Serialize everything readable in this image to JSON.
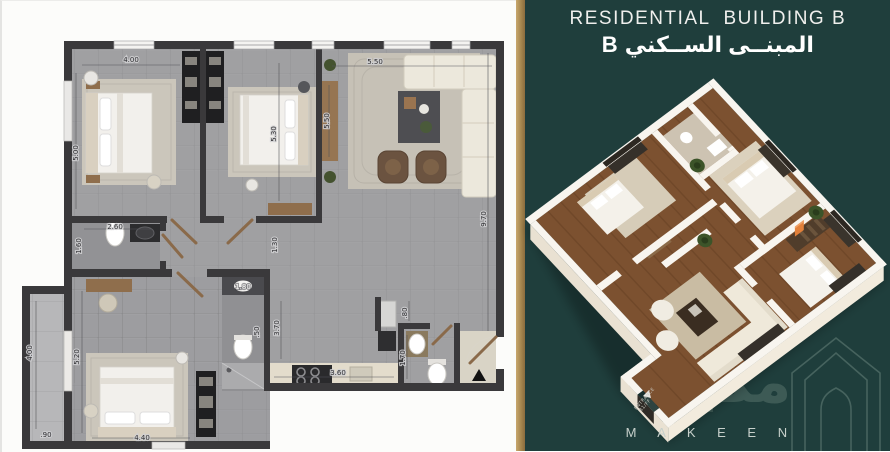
{
  "right_panel": {
    "title_en": "RESIDENTIAL  BUILDING B",
    "title_ar": "المبنــى الســكني B",
    "brand": {
      "name_en": "M A K E E N",
      "name_ar": "مكين"
    },
    "entrance_tag": {
      "line1": "ENTRANCE",
      "line2": "B1/FF"
    },
    "colors": {
      "background": "#1f3e3c",
      "gold_strip": "#a5874f",
      "watermark": "#3d5a55",
      "wood_floor": "#7c5130",
      "wall_white": "#f8f5ef",
      "accent_tag_orange": "#e2803a"
    }
  },
  "floor_plan": {
    "colors": {
      "wall": "#3a393b",
      "floor_gray": "#a0a0a2",
      "balcony_gray": "#b7b7b9",
      "rug": "#cbc6bb",
      "wood": "#8f6e4c",
      "fixture_white": "#f4f3f1"
    },
    "rooms": [
      {
        "id": "bedroom-1",
        "dims": [
          "4.00",
          "5.00"
        ]
      },
      {
        "id": "bedroom-2",
        "dims": [
          "5.30",
          "5.50"
        ]
      },
      {
        "id": "living-room",
        "dims": [
          "5.50",
          "9.70"
        ]
      },
      {
        "id": "bathroom",
        "dims": [
          "2.60",
          "1.60"
        ]
      },
      {
        "id": "corridor",
        "dims": [
          "1.30"
        ]
      },
      {
        "id": "ensuite-bathroom",
        "dims": [
          "1.80",
          ".50"
        ]
      },
      {
        "id": "master-bedroom",
        "dims": [
          "5.20",
          "4.40"
        ]
      },
      {
        "id": "balcony",
        "dims": [
          "4.00",
          ".90"
        ]
      },
      {
        "id": "kitchen",
        "dims": [
          "3.60",
          "3.70"
        ]
      },
      {
        "id": "wc",
        "dims": [
          "1.70",
          ".80"
        ]
      }
    ],
    "dimensions": [
      {
        "v": "4.00",
        "x": 129,
        "y": 61,
        "r": 0
      },
      {
        "v": "5.00",
        "x": 76,
        "y": 152,
        "r": -90
      },
      {
        "v": "5.30",
        "x": 274,
        "y": 133,
        "r": -90
      },
      {
        "v": "5.50",
        "x": 327,
        "y": 120,
        "r": -90
      },
      {
        "v": "5.50",
        "x": 373,
        "y": 63,
        "r": 0
      },
      {
        "v": "9.70",
        "x": 484,
        "y": 218,
        "r": -90
      },
      {
        "v": "2.60",
        "x": 113,
        "y": 228,
        "r": 0
      },
      {
        "v": "1.60",
        "x": 79,
        "y": 245,
        "r": -90
      },
      {
        "v": "1.30",
        "x": 275,
        "y": 244,
        "r": -90
      },
      {
        "v": "1.80",
        "x": 241,
        "y": 288,
        "r": 0,
        "light": true
      },
      {
        "v": "5.20",
        "x": 77,
        "y": 356,
        "r": -90
      },
      {
        "v": "4.40",
        "x": 140,
        "y": 439,
        "r": 0
      },
      {
        "v": "4.00",
        "x": 30,
        "y": 352,
        "r": -90
      },
      {
        "v": ".90",
        "x": 44,
        "y": 436,
        "r": 0
      },
      {
        "v": "3.70",
        "x": 277,
        "y": 327,
        "r": -90
      },
      {
        "v": ".50",
        "x": 257,
        "y": 331,
        "r": -90
      },
      {
        "v": "3.60",
        "x": 336,
        "y": 374,
        "r": 0
      },
      {
        "v": ".80",
        "x": 405,
        "y": 312,
        "r": -90
      },
      {
        "v": "1.70",
        "x": 403,
        "y": 357,
        "r": -90
      }
    ]
  }
}
